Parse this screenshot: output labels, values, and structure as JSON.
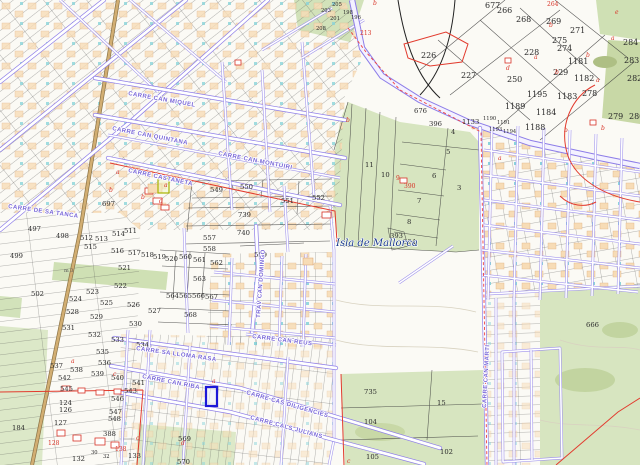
{
  "map": {
    "type": "cadastral-parcel-map",
    "place_label": {
      "text": "Isla de Mallorca",
      "x": 336,
      "y": 246
    },
    "scale_note": {
      "text": "m 3",
      "x": 64,
      "y": 272
    },
    "colors": {
      "road_purple": "#8d7de8",
      "parcel_line": "#3a3a3a",
      "field_green": "#d7e5c0",
      "building_peach": "#f7dcb6",
      "boundary_red": "#e23b2e",
      "selected_blue": "#1c17d8",
      "camino_tan": "#d2ae72",
      "street_label": "#7a68d8",
      "place_blue": "#1b3a8c"
    },
    "selected_parcel": {
      "x": 206,
      "y": 387,
      "w": 11,
      "h": 19
    },
    "street_labels": [
      {
        "text": "CARRE CAN MIQUEL",
        "x": 128,
        "y": 95,
        "rot": 10
      },
      {
        "text": "CARRE CAN QUINTANA",
        "x": 112,
        "y": 130,
        "rot": 11
      },
      {
        "text": "CARRE CAN MONTUIRI",
        "x": 218,
        "y": 155,
        "rot": 11
      },
      {
        "text": "CARRE CASTANETA",
        "x": 128,
        "y": 172,
        "rot": 12
      },
      {
        "text": "CARRE DE SA TANCA",
        "x": 8,
        "y": 208,
        "rot": 8
      },
      {
        "text": "CARRE SA LLOMA RASA",
        "x": 136,
        "y": 350,
        "rot": 8
      },
      {
        "text": "CARRE CAN RIBA",
        "x": 142,
        "y": 378,
        "rot": 11
      },
      {
        "text": "CARRE CAS DILIGENCIES",
        "x": 246,
        "y": 394,
        "rot": 16
      },
      {
        "text": "CARRE CALS JULIANS",
        "x": 250,
        "y": 419,
        "rot": 15
      },
      {
        "text": "CARRE CAN REUS",
        "x": 252,
        "y": 338,
        "rot": 7
      },
      {
        "text": "TRAV CAN DOMINGO",
        "x": 260,
        "y": 318,
        "rot": -86
      },
      {
        "text": "CARRE CAN MARTI",
        "x": 486,
        "y": 408,
        "rot": -87
      }
    ],
    "parcel_numbers": [
      {
        "t": "497",
        "x": 28,
        "y": 231
      },
      {
        "t": "498",
        "x": 56,
        "y": 238
      },
      {
        "t": "499",
        "x": 10,
        "y": 258
      },
      {
        "t": "502",
        "x": 31,
        "y": 296
      },
      {
        "t": "511",
        "x": 124,
        "y": 233
      },
      {
        "t": "512",
        "x": 80,
        "y": 240
      },
      {
        "t": "513",
        "x": 95,
        "y": 241
      },
      {
        "t": "514",
        "x": 112,
        "y": 236
      },
      {
        "t": "515",
        "x": 84,
        "y": 249
      },
      {
        "t": "516",
        "x": 111,
        "y": 253
      },
      {
        "t": "517",
        "x": 128,
        "y": 255
      },
      {
        "t": "518",
        "x": 141,
        "y": 257
      },
      {
        "t": "519",
        "x": 153,
        "y": 259
      },
      {
        "t": "520",
        "x": 165,
        "y": 261
      },
      {
        "t": "521",
        "x": 118,
        "y": 270
      },
      {
        "t": "522",
        "x": 114,
        "y": 288
      },
      {
        "t": "523",
        "x": 86,
        "y": 294
      },
      {
        "t": "524",
        "x": 69,
        "y": 301
      },
      {
        "t": "525",
        "x": 100,
        "y": 305
      },
      {
        "t": "526",
        "x": 127,
        "y": 307
      },
      {
        "t": "527",
        "x": 148,
        "y": 313
      },
      {
        "t": "528",
        "x": 66,
        "y": 314
      },
      {
        "t": "529",
        "x": 90,
        "y": 319
      },
      {
        "t": "530",
        "x": 129,
        "y": 326
      },
      {
        "t": "531",
        "x": 62,
        "y": 330
      },
      {
        "t": "532",
        "x": 88,
        "y": 337
      },
      {
        "t": "533",
        "x": 111,
        "y": 342
      },
      {
        "t": "534",
        "x": 136,
        "y": 347
      },
      {
        "t": "535",
        "x": 96,
        "y": 354
      },
      {
        "t": "536",
        "x": 98,
        "y": 365
      },
      {
        "t": "537",
        "x": 50,
        "y": 368
      },
      {
        "t": "538",
        "x": 70,
        "y": 372
      },
      {
        "t": "539",
        "x": 91,
        "y": 376
      },
      {
        "t": "540",
        "x": 111,
        "y": 380
      },
      {
        "t": "541",
        "x": 132,
        "y": 385
      },
      {
        "t": "542",
        "x": 58,
        "y": 380
      },
      {
        "t": "543",
        "x": 124,
        "y": 393
      },
      {
        "t": "545",
        "x": 60,
        "y": 391
      },
      {
        "t": "546",
        "x": 111,
        "y": 401
      },
      {
        "t": "547",
        "x": 109,
        "y": 414
      },
      {
        "t": "548",
        "x": 108,
        "y": 421
      },
      {
        "t": "124",
        "x": 59,
        "y": 405
      },
      {
        "t": "126",
        "x": 59,
        "y": 412
      },
      {
        "t": "127",
        "x": 54,
        "y": 425
      },
      {
        "t": "184",
        "x": 12,
        "y": 430
      },
      {
        "t": "388",
        "x": 103,
        "y": 436
      },
      {
        "t": "132",
        "x": 72,
        "y": 461
      },
      {
        "t": "133",
        "x": 128,
        "y": 458
      },
      {
        "t": "569",
        "x": 178,
        "y": 441
      },
      {
        "t": "570",
        "x": 177,
        "y": 464
      },
      {
        "t": "697",
        "x": 102,
        "y": 206
      },
      {
        "t": "549",
        "x": 210,
        "y": 192
      },
      {
        "t": "550",
        "x": 240,
        "y": 189
      },
      {
        "t": "551",
        "x": 281,
        "y": 203
      },
      {
        "t": "552",
        "x": 312,
        "y": 200
      },
      {
        "t": "739",
        "x": 238,
        "y": 217
      },
      {
        "t": "740",
        "x": 237,
        "y": 235
      },
      {
        "t": "557",
        "x": 203,
        "y": 240
      },
      {
        "t": "558",
        "x": 203,
        "y": 251
      },
      {
        "t": "559",
        "x": 254,
        "y": 257
      },
      {
        "t": "560",
        "x": 179,
        "y": 259
      },
      {
        "t": "561",
        "x": 193,
        "y": 262
      },
      {
        "t": "562",
        "x": 210,
        "y": 265
      },
      {
        "t": "563",
        "x": 193,
        "y": 281
      },
      {
        "t": "564",
        "x": 166,
        "y": 298
      },
      {
        "t": "565",
        "x": 179,
        "y": 298
      },
      {
        "t": "566",
        "x": 192,
        "y": 298
      },
      {
        "t": "567",
        "x": 205,
        "y": 299
      },
      {
        "t": "568",
        "x": 184,
        "y": 317
      },
      {
        "t": "676",
        "x": 414,
        "y": 113
      },
      {
        "t": "396",
        "x": 429,
        "y": 126
      },
      {
        "t": "1133",
        "x": 462,
        "y": 124
      },
      {
        "t": "4",
        "x": 451,
        "y": 134
      },
      {
        "t": "5",
        "x": 446,
        "y": 154
      },
      {
        "t": "6",
        "x": 432,
        "y": 178
      },
      {
        "t": "3",
        "x": 457,
        "y": 190
      },
      {
        "t": "7",
        "x": 417,
        "y": 203
      },
      {
        "t": "8",
        "x": 407,
        "y": 224
      },
      {
        "t": "10",
        "x": 381,
        "y": 177
      },
      {
        "t": "11",
        "x": 365,
        "y": 167
      },
      {
        "t": "393",
        "x": 390,
        "y": 238
      },
      {
        "t": "394",
        "x": 403,
        "y": 244
      },
      {
        "t": "666",
        "x": 586,
        "y": 327
      },
      {
        "t": "735",
        "x": 364,
        "y": 394
      },
      {
        "t": "15",
        "x": 437,
        "y": 405
      },
      {
        "t": "104",
        "x": 364,
        "y": 424
      },
      {
        "t": "102",
        "x": 440,
        "y": 454
      },
      {
        "t": "105",
        "x": 366,
        "y": 459
      }
    ],
    "parcel_numbers_big": [
      {
        "t": "677",
        "x": 485,
        "y": 8
      },
      {
        "t": "266",
        "x": 497,
        "y": 13
      },
      {
        "t": "268",
        "x": 516,
        "y": 22
      },
      {
        "t": "269",
        "x": 546,
        "y": 24
      },
      {
        "t": "271",
        "x": 570,
        "y": 33
      },
      {
        "t": "275",
        "x": 552,
        "y": 43
      },
      {
        "t": "274",
        "x": 557,
        "y": 51
      },
      {
        "t": "226",
        "x": 421,
        "y": 58
      },
      {
        "t": "227",
        "x": 461,
        "y": 78
      },
      {
        "t": "228",
        "x": 524,
        "y": 55
      },
      {
        "t": "1181",
        "x": 568,
        "y": 64
      },
      {
        "t": "229",
        "x": 553,
        "y": 75
      },
      {
        "t": "1182",
        "x": 574,
        "y": 81
      },
      {
        "t": "250",
        "x": 507,
        "y": 82
      },
      {
        "t": "1195",
        "x": 527,
        "y": 97
      },
      {
        "t": "1183",
        "x": 557,
        "y": 99
      },
      {
        "t": "278",
        "x": 582,
        "y": 96
      },
      {
        "t": "284",
        "x": 623,
        "y": 45
      },
      {
        "t": "283",
        "x": 624,
        "y": 63
      },
      {
        "t": "282",
        "x": 627,
        "y": 81
      },
      {
        "t": "279",
        "x": 608,
        "y": 119
      },
      {
        "t": "280",
        "x": 629,
        "y": 119
      },
      {
        "t": "1189",
        "x": 505,
        "y": 109
      },
      {
        "t": "1184",
        "x": 536,
        "y": 115
      },
      {
        "t": "1188",
        "x": 525,
        "y": 130
      }
    ],
    "parcel_numbers_tiny": [
      {
        "t": "205",
        "x": 332,
        "y": 6
      },
      {
        "t": "203",
        "x": 321,
        "y": 12
      },
      {
        "t": "201",
        "x": 330,
        "y": 20
      },
      {
        "t": "208",
        "x": 316,
        "y": 30
      },
      {
        "t": "198",
        "x": 343,
        "y": 14
      },
      {
        "t": "196",
        "x": 351,
        "y": 19
      },
      {
        "t": "1190",
        "x": 483,
        "y": 120
      },
      {
        "t": "1191",
        "x": 497,
        "y": 124
      },
      {
        "t": "1193",
        "x": 489,
        "y": 131
      },
      {
        "t": "1194",
        "x": 503,
        "y": 133
      },
      {
        "t": "30",
        "x": 91,
        "y": 454
      },
      {
        "t": "32",
        "x": 103,
        "y": 458
      }
    ],
    "red_numbers": [
      {
        "t": "264",
        "x": 547,
        "y": 6
      },
      {
        "t": "213",
        "x": 360,
        "y": 35
      },
      {
        "t": "390",
        "x": 404,
        "y": 188
      },
      {
        "t": "9",
        "x": 396,
        "y": 180
      },
      {
        "t": "128",
        "x": 48,
        "y": 445
      },
      {
        "t": "138",
        "x": 115,
        "y": 451
      }
    ],
    "red_letters": [
      {
        "t": "a",
        "x": 116,
        "y": 174
      },
      {
        "t": "a",
        "x": 164,
        "y": 187
      },
      {
        "t": "b",
        "x": 141,
        "y": 199
      },
      {
        "t": "b",
        "x": 109,
        "y": 192
      },
      {
        "t": "d",
        "x": 159,
        "y": 203
      },
      {
        "t": "b",
        "x": 373,
        "y": 5
      },
      {
        "t": "b",
        "x": 549,
        "y": 27
      },
      {
        "t": "a",
        "x": 611,
        "y": 40
      },
      {
        "t": "b",
        "x": 586,
        "y": 57
      },
      {
        "t": "a",
        "x": 534,
        "y": 59
      },
      {
        "t": "b",
        "x": 555,
        "y": 74
      },
      {
        "t": "e",
        "x": 615,
        "y": 14
      },
      {
        "t": "a",
        "x": 596,
        "y": 82
      },
      {
        "t": "b",
        "x": 601,
        "y": 130
      },
      {
        "t": "b",
        "x": 564,
        "y": 132
      },
      {
        "t": "d",
        "x": 506,
        "y": 70
      },
      {
        "t": "b",
        "x": 346,
        "y": 122
      },
      {
        "t": "a",
        "x": 212,
        "y": 383
      },
      {
        "t": "c",
        "x": 113,
        "y": 376
      },
      {
        "t": "c",
        "x": 136,
        "y": 440
      },
      {
        "t": "d",
        "x": 181,
        "y": 445
      },
      {
        "t": "a",
        "x": 71,
        "y": 363
      },
      {
        "t": "c",
        "x": 347,
        "y": 463
      },
      {
        "t": "a",
        "x": 498,
        "y": 160
      }
    ]
  }
}
